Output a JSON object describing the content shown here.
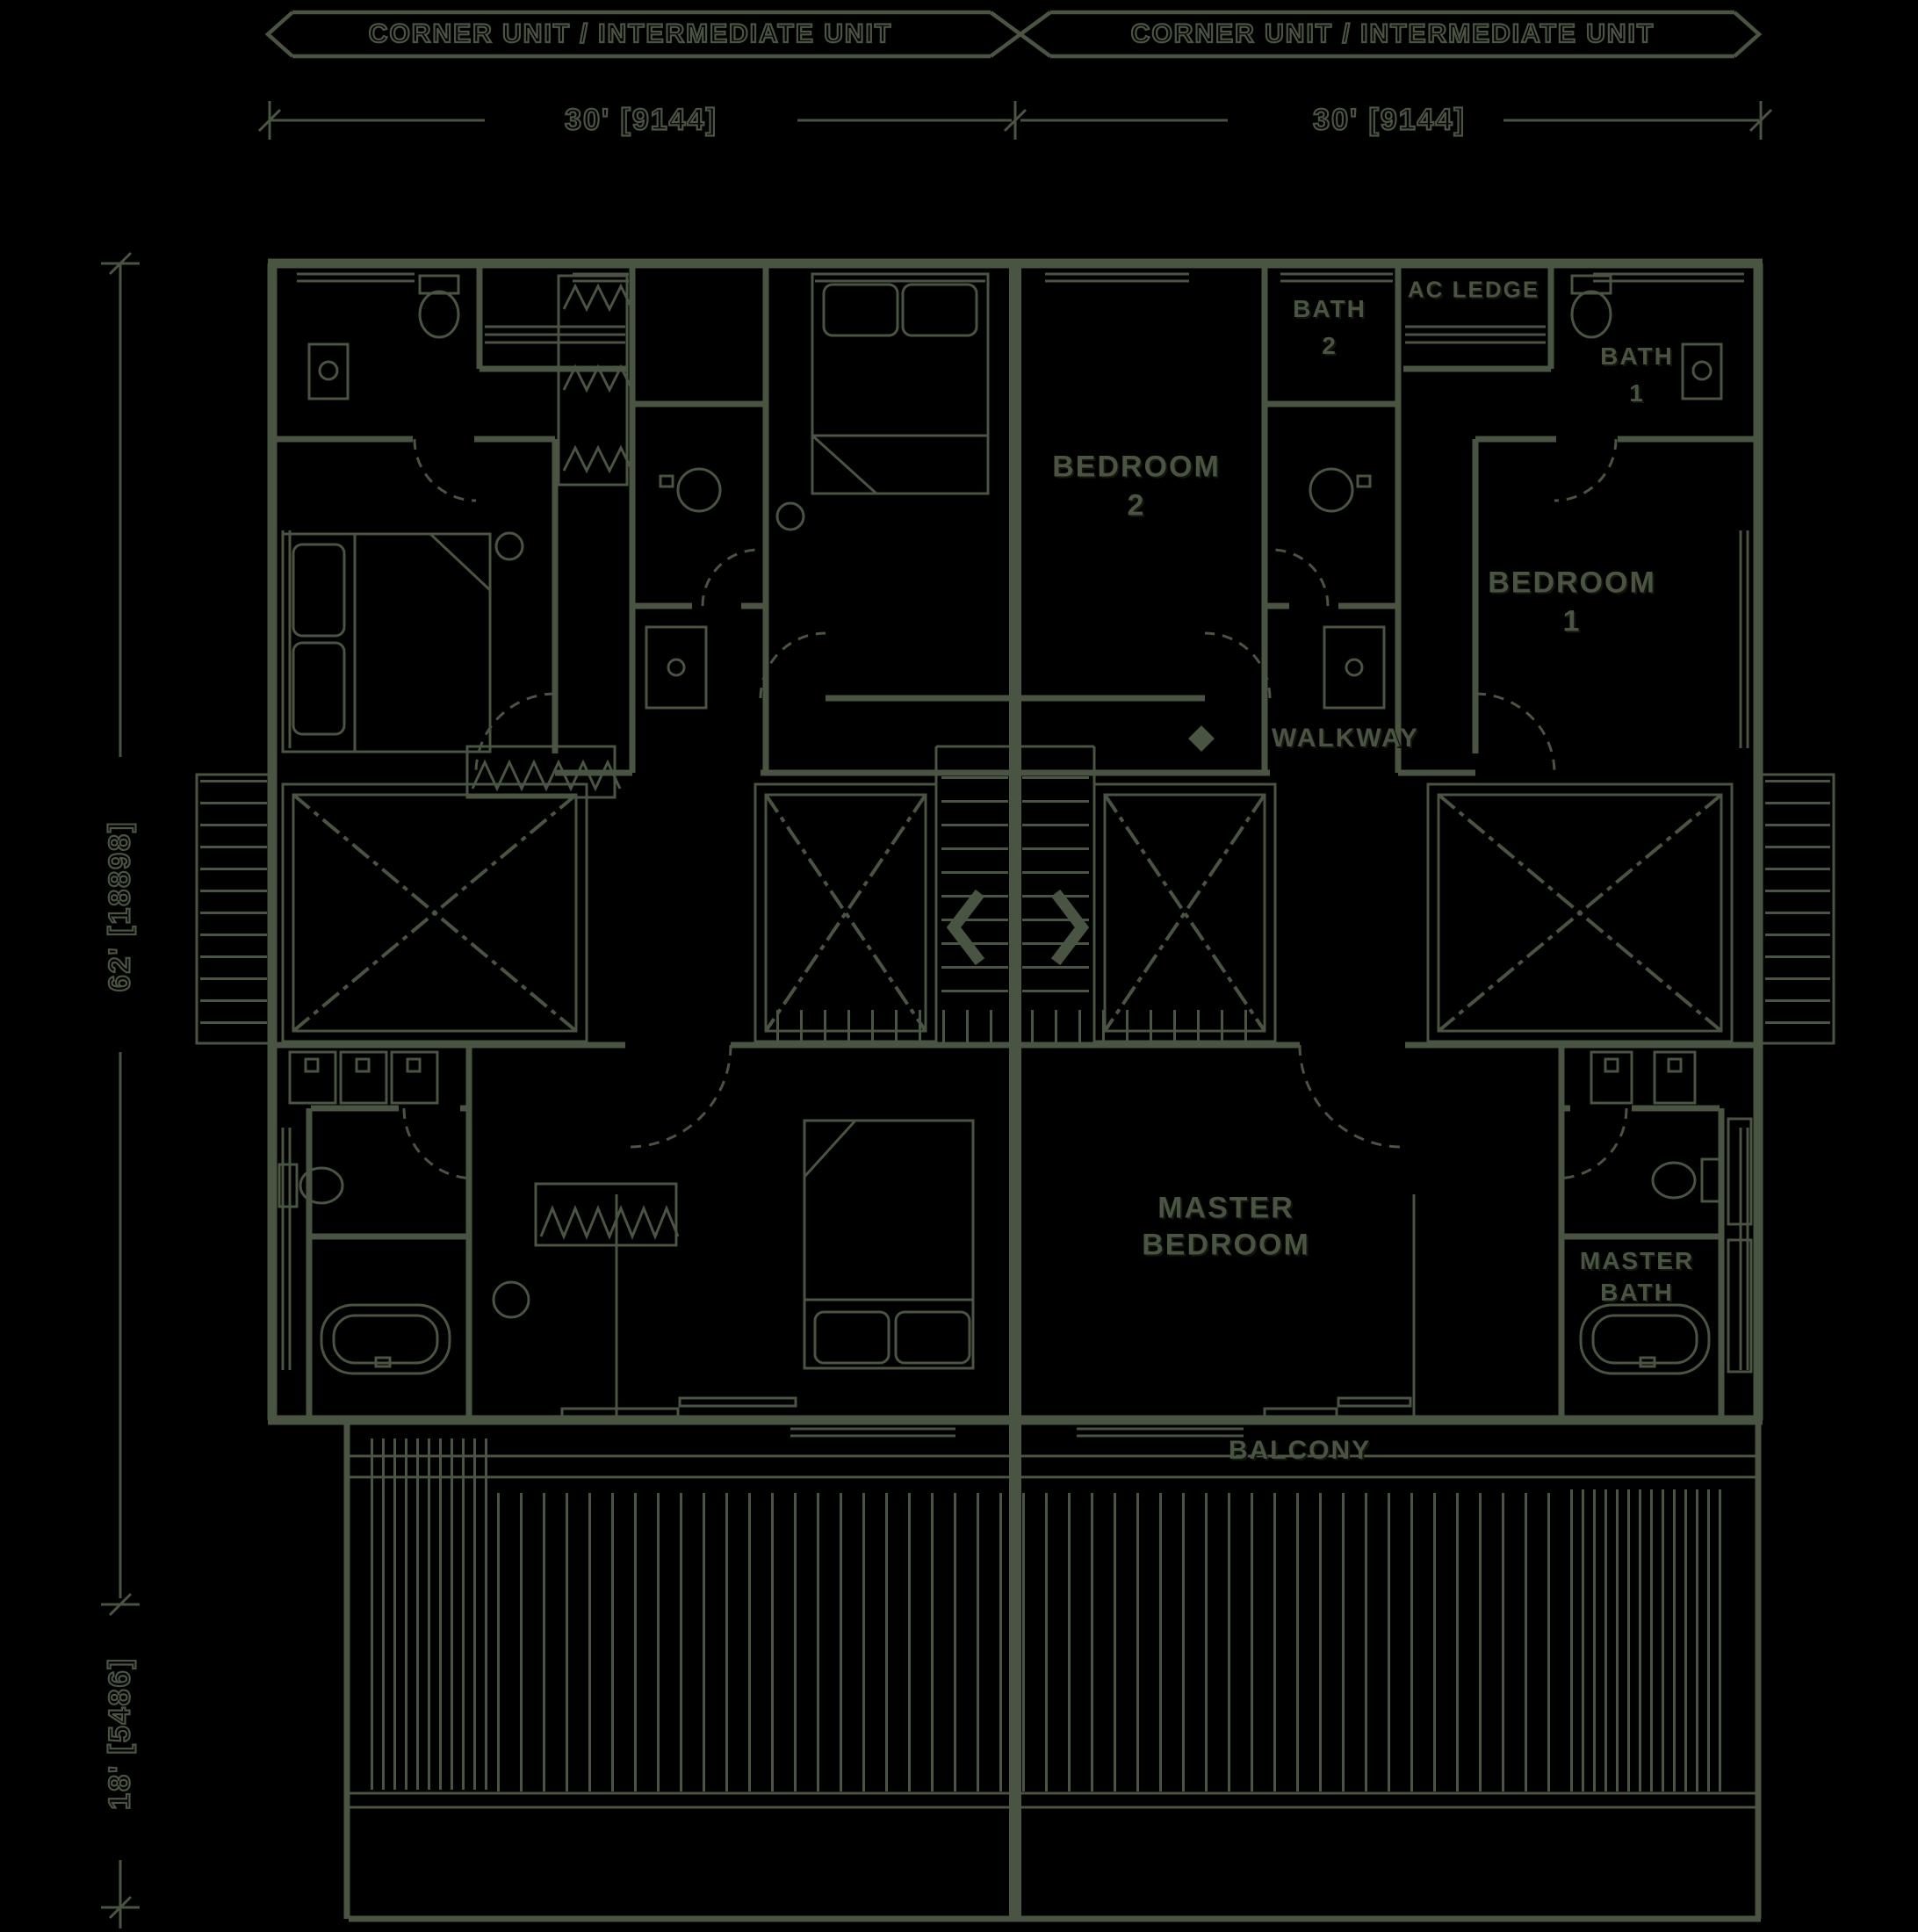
{
  "colors": {
    "ink": "#4a5442",
    "background": "#000000"
  },
  "banners": {
    "left": "CORNER UNIT / INTERMEDIATE UNIT",
    "right": "CORNER UNIT / INTERMEDIATE UNIT"
  },
  "dimensions": {
    "top_left": "30' [9144]",
    "top_right": "30' [9144]",
    "side_upper": "62' [18898]",
    "side_lower": "18' [5486]"
  },
  "rooms": {
    "bath2_line1": "BATH",
    "bath2_line2": "2",
    "ac_ledge": "AC LEDGE",
    "bath1_line1": "BATH",
    "bath1_line2": "1",
    "bedroom2_line1": "BEDROOM",
    "bedroom2_line2": "2",
    "bedroom1_line1": "BEDROOM",
    "bedroom1_line2": "1",
    "walkway": "WALKWAY",
    "master_bedroom_line1": "MASTER",
    "master_bedroom_line2": "BEDROOM",
    "master_bath_line1": "MASTER",
    "master_bath_line2": "BATH",
    "balcony": "BALCONY"
  }
}
